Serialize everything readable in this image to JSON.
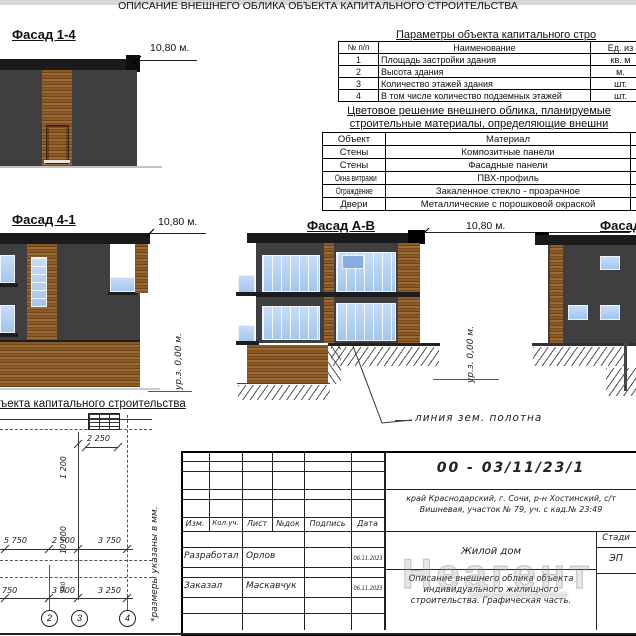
{
  "header": {
    "title": "ОПИСАНИЕ ВНЕШНЕГО ОБЛИКА ОБЪЕКТА КАПИТАЛЬНОГО СТРОИТЕЛЬСТВА"
  },
  "facade14": {
    "label": "Фасад 1-4",
    "dim": "10,80 м."
  },
  "facade41": {
    "label": "Фасад 4-1",
    "dim": "10,80 м.",
    "level": "ур.з. 0,00 м."
  },
  "facadeAB": {
    "label": "Фасад А-В",
    "dim": "10,80 м.",
    "level": "ур.з. 0,00 м.",
    "ground_line_label": "линия зем. полотна"
  },
  "facadeRight": {
    "label": "Фасад"
  },
  "params_table": {
    "title": "Параметры объекта капитального стро",
    "col_headers": [
      "№ п/п",
      "Наименование",
      "Ед. из"
    ],
    "rows": [
      {
        "num": "1",
        "name": "Площадь застройки здания",
        "unit": "кв. м"
      },
      {
        "num": "2",
        "name": "Высота здания",
        "unit": "м."
      },
      {
        "num": "3",
        "name": "Количество этажей здания",
        "unit": "шт."
      },
      {
        "num": "4",
        "name": "В том числе количество подземных этажей",
        "unit": "шт."
      }
    ]
  },
  "materials_table": {
    "title_line1": "Цветовое решение внешнего облика, планируемые",
    "title_line2": "строительные материалы, определяющие внешни",
    "col_headers": [
      "Объект",
      "Материал"
    ],
    "rows": [
      {
        "object": "Стены",
        "material": "Композитные панели"
      },
      {
        "object": "Стены",
        "material": "Фасадные панели"
      },
      {
        "object": "Окна витражи",
        "material": "ПВХ-профиль"
      },
      {
        "object": "Ограждение",
        "material": "Закаленное стекло - прозрачное"
      },
      {
        "object": "Двери",
        "material": "Металлические с порошковой окраской"
      }
    ]
  },
  "plan": {
    "title_fragment": "ъекта капитального строительства",
    "note_vertical": "*размеры указаны в мм.",
    "dim_top": "2 250",
    "dim_v1": "1 200",
    "dim_v2": "10 000",
    "dim_vsmall": "380",
    "dim_mid": [
      "5 750",
      "2 500",
      "3 750"
    ],
    "dim_bottom": [
      "750",
      "3 900",
      "3 250"
    ],
    "axis_labels": [
      "2",
      "3",
      "4"
    ]
  },
  "title_block": {
    "doc_code": "00 - 03/11/23/1",
    "address_line1": "край Краснодарский, г. Сочи, р-н Хостинский, с/т",
    "address_line2": "Вишневая, участок № 79, уч. с кад.№ 23:49",
    "col_headers": [
      "Изм.",
      "Кол.уч.",
      "Лист",
      "№док",
      "Подпись",
      "Дата"
    ],
    "row_developer": {
      "role": "Разработал",
      "name": "Орлов",
      "date": "06.11.2023"
    },
    "row_customer": {
      "role": "Заказал",
      "name": "Маскавчук",
      "date": "06.11.2023"
    },
    "project_name": "Жилой дом",
    "doc_desc_line1": "Описание внешнего облика объекта",
    "doc_desc_line2": "индивидуального жилищного",
    "doc_desc_line3": "строительства. Графическая часть.",
    "stage_label": "Стади",
    "stage_value": "ЭП",
    "watermark": "Неагент"
  },
  "colors": {
    "wall": "#3f3f41",
    "roof": "#1b1b1d",
    "wood": "#8a5a2a",
    "window": "#aecdf2",
    "line": "#222222"
  }
}
